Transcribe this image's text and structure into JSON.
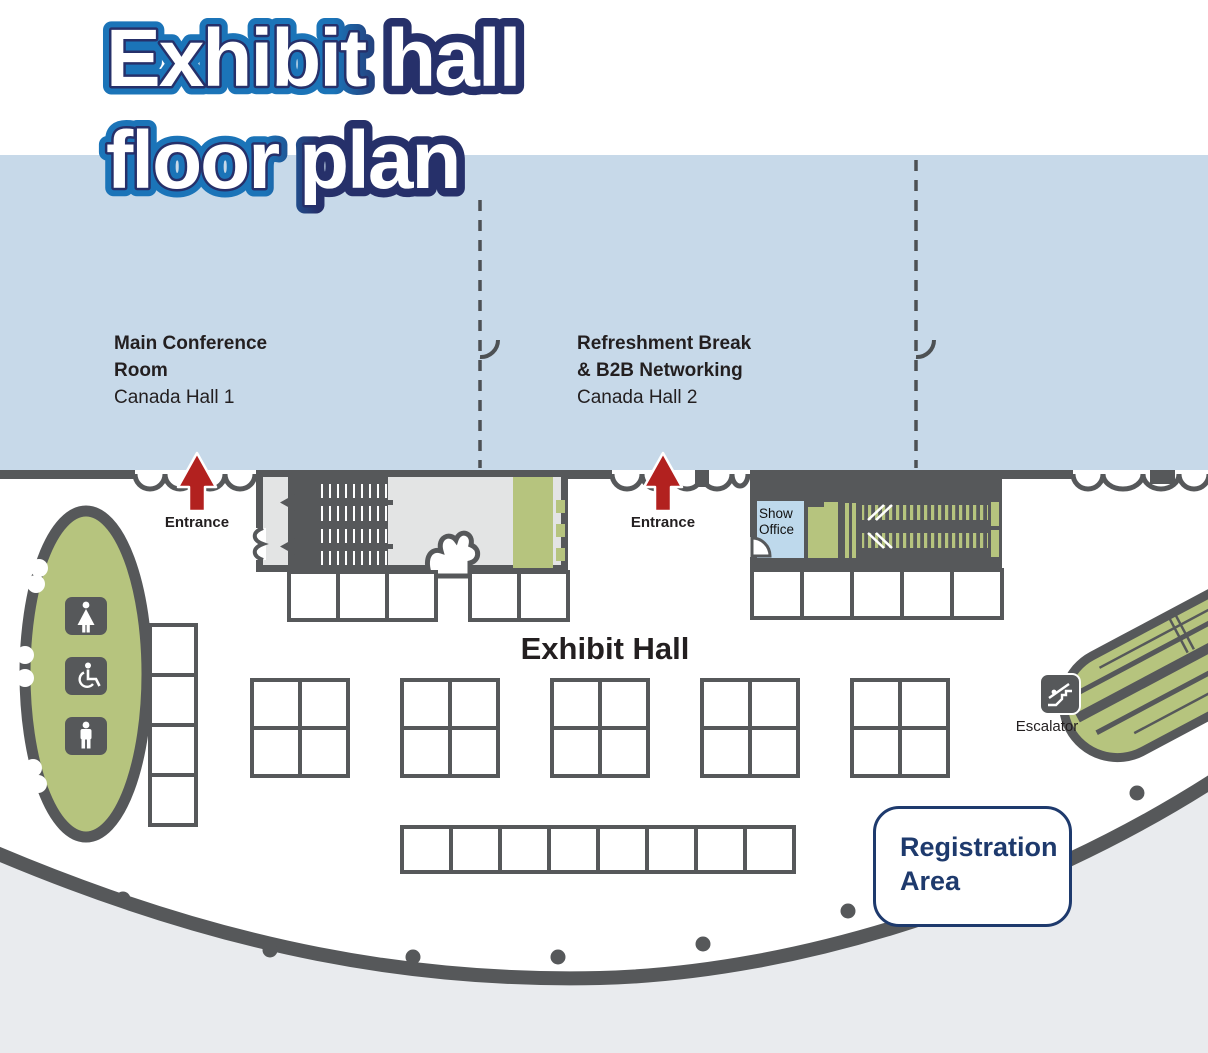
{
  "colors": {
    "wall": "#56585a",
    "blue": "#c7d9e9",
    "green": "#b6c47e",
    "bldg": "#e3e4e4",
    "outside": "#e9ebee",
    "red": "#b2211f",
    "navy": "#1e3a6d",
    "title-blue": "#1b74b8",
    "title-navy": "#26306a",
    "office-blue": "#bed9ec"
  },
  "title": {
    "line1": "Exhibit hall",
    "line2": "floor plan"
  },
  "halls": {
    "main": {
      "line1": "Main Conference",
      "line2": "Room",
      "sub": "Canada Hall 1"
    },
    "refreshment": {
      "line1": "Refreshment Break",
      "line2": "& B2B Networking",
      "sub": "Canada Hall 2"
    }
  },
  "labels": {
    "entrance": "Entrance",
    "exhibit_hall": "Exhibit Hall",
    "show_office": "Show Office",
    "escalator": "Escalator",
    "registration_line1": "Registration",
    "registration_line2": "Area"
  }
}
